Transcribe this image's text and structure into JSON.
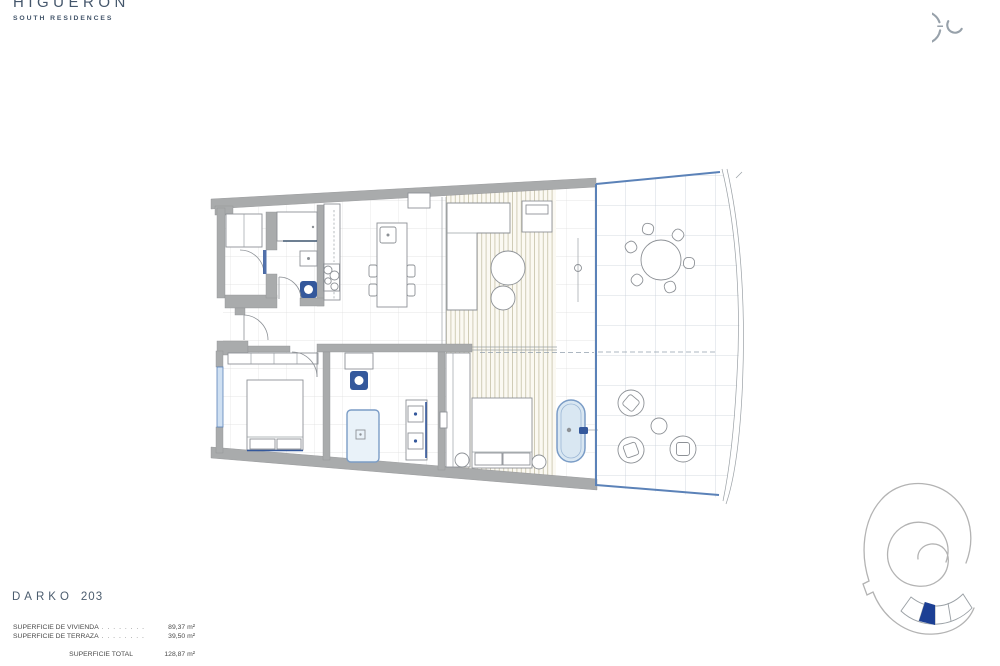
{
  "brand": {
    "name": "HIGUERON",
    "subtitle": "SOUTH RESIDENCES"
  },
  "unit": {
    "model": "DARKO",
    "number": "203"
  },
  "surfaces": {
    "rows": [
      {
        "label": "SUPERFICIE DE VIVIENDA",
        "leader": ". . . . . . . . . .",
        "value": "89,37 m²"
      },
      {
        "label": "SUPERFICIE DE TERRAZA",
        "leader": ". . . . . . . . . .",
        "value": "39,50 m²"
      }
    ],
    "total": {
      "label": "SUPERFICIE TOTAL",
      "value": "128,87 m²"
    }
  },
  "colors": {
    "brand_text": "#44566b",
    "title_text": "#4b5c6e",
    "body_text": "#4a4a4a",
    "wall_gray": "#a9abac",
    "glass_blue": "#5b82b8",
    "fixture_blue": "#34589c",
    "window_fill": "#cfe0f2",
    "slat_line": "#bfba9e",
    "grid_interior": "#dedede",
    "grid_terrace": "#c8cfd9",
    "keyplan_outline": "#b3b3b3",
    "keyplan_highlight": "#1c3f94"
  }
}
